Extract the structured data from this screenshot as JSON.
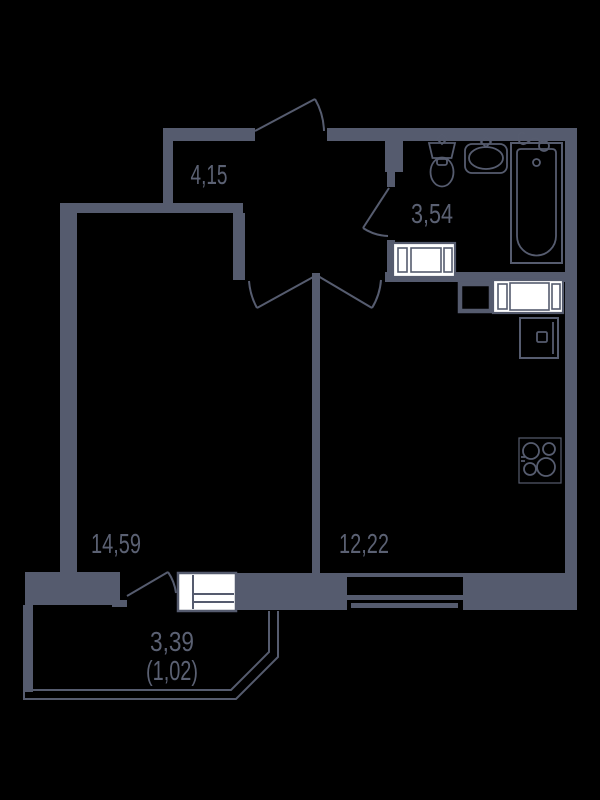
{
  "plan": {
    "type": "apartment-floor-plan",
    "rooms": [
      {
        "name": "hallway",
        "area": "4,15"
      },
      {
        "name": "bathroom",
        "area": "3,54"
      },
      {
        "name": "living-room",
        "area": "14,59"
      },
      {
        "name": "kitchen",
        "area": "12,22"
      },
      {
        "name": "balcony",
        "area": "3,39",
        "area_reduced": "(1,02)"
      }
    ],
    "fixtures": [
      "entrance-door",
      "hall-double-doors",
      "bathroom-door",
      "balcony-door",
      "toilet",
      "washbasin",
      "bathtub",
      "shower-hose",
      "washing-machine",
      "kitchen-appliance",
      "ventilation-duct",
      "kitchen-sink",
      "stove-4-burners",
      "kitchen-window",
      "balcony-window",
      "balcony-railing"
    ],
    "colors": {
      "wall": "#555b6e",
      "line": "#565c6f",
      "label": "#5b6173",
      "fixture_fill": "#ffffff",
      "background": "#000000"
    }
  }
}
